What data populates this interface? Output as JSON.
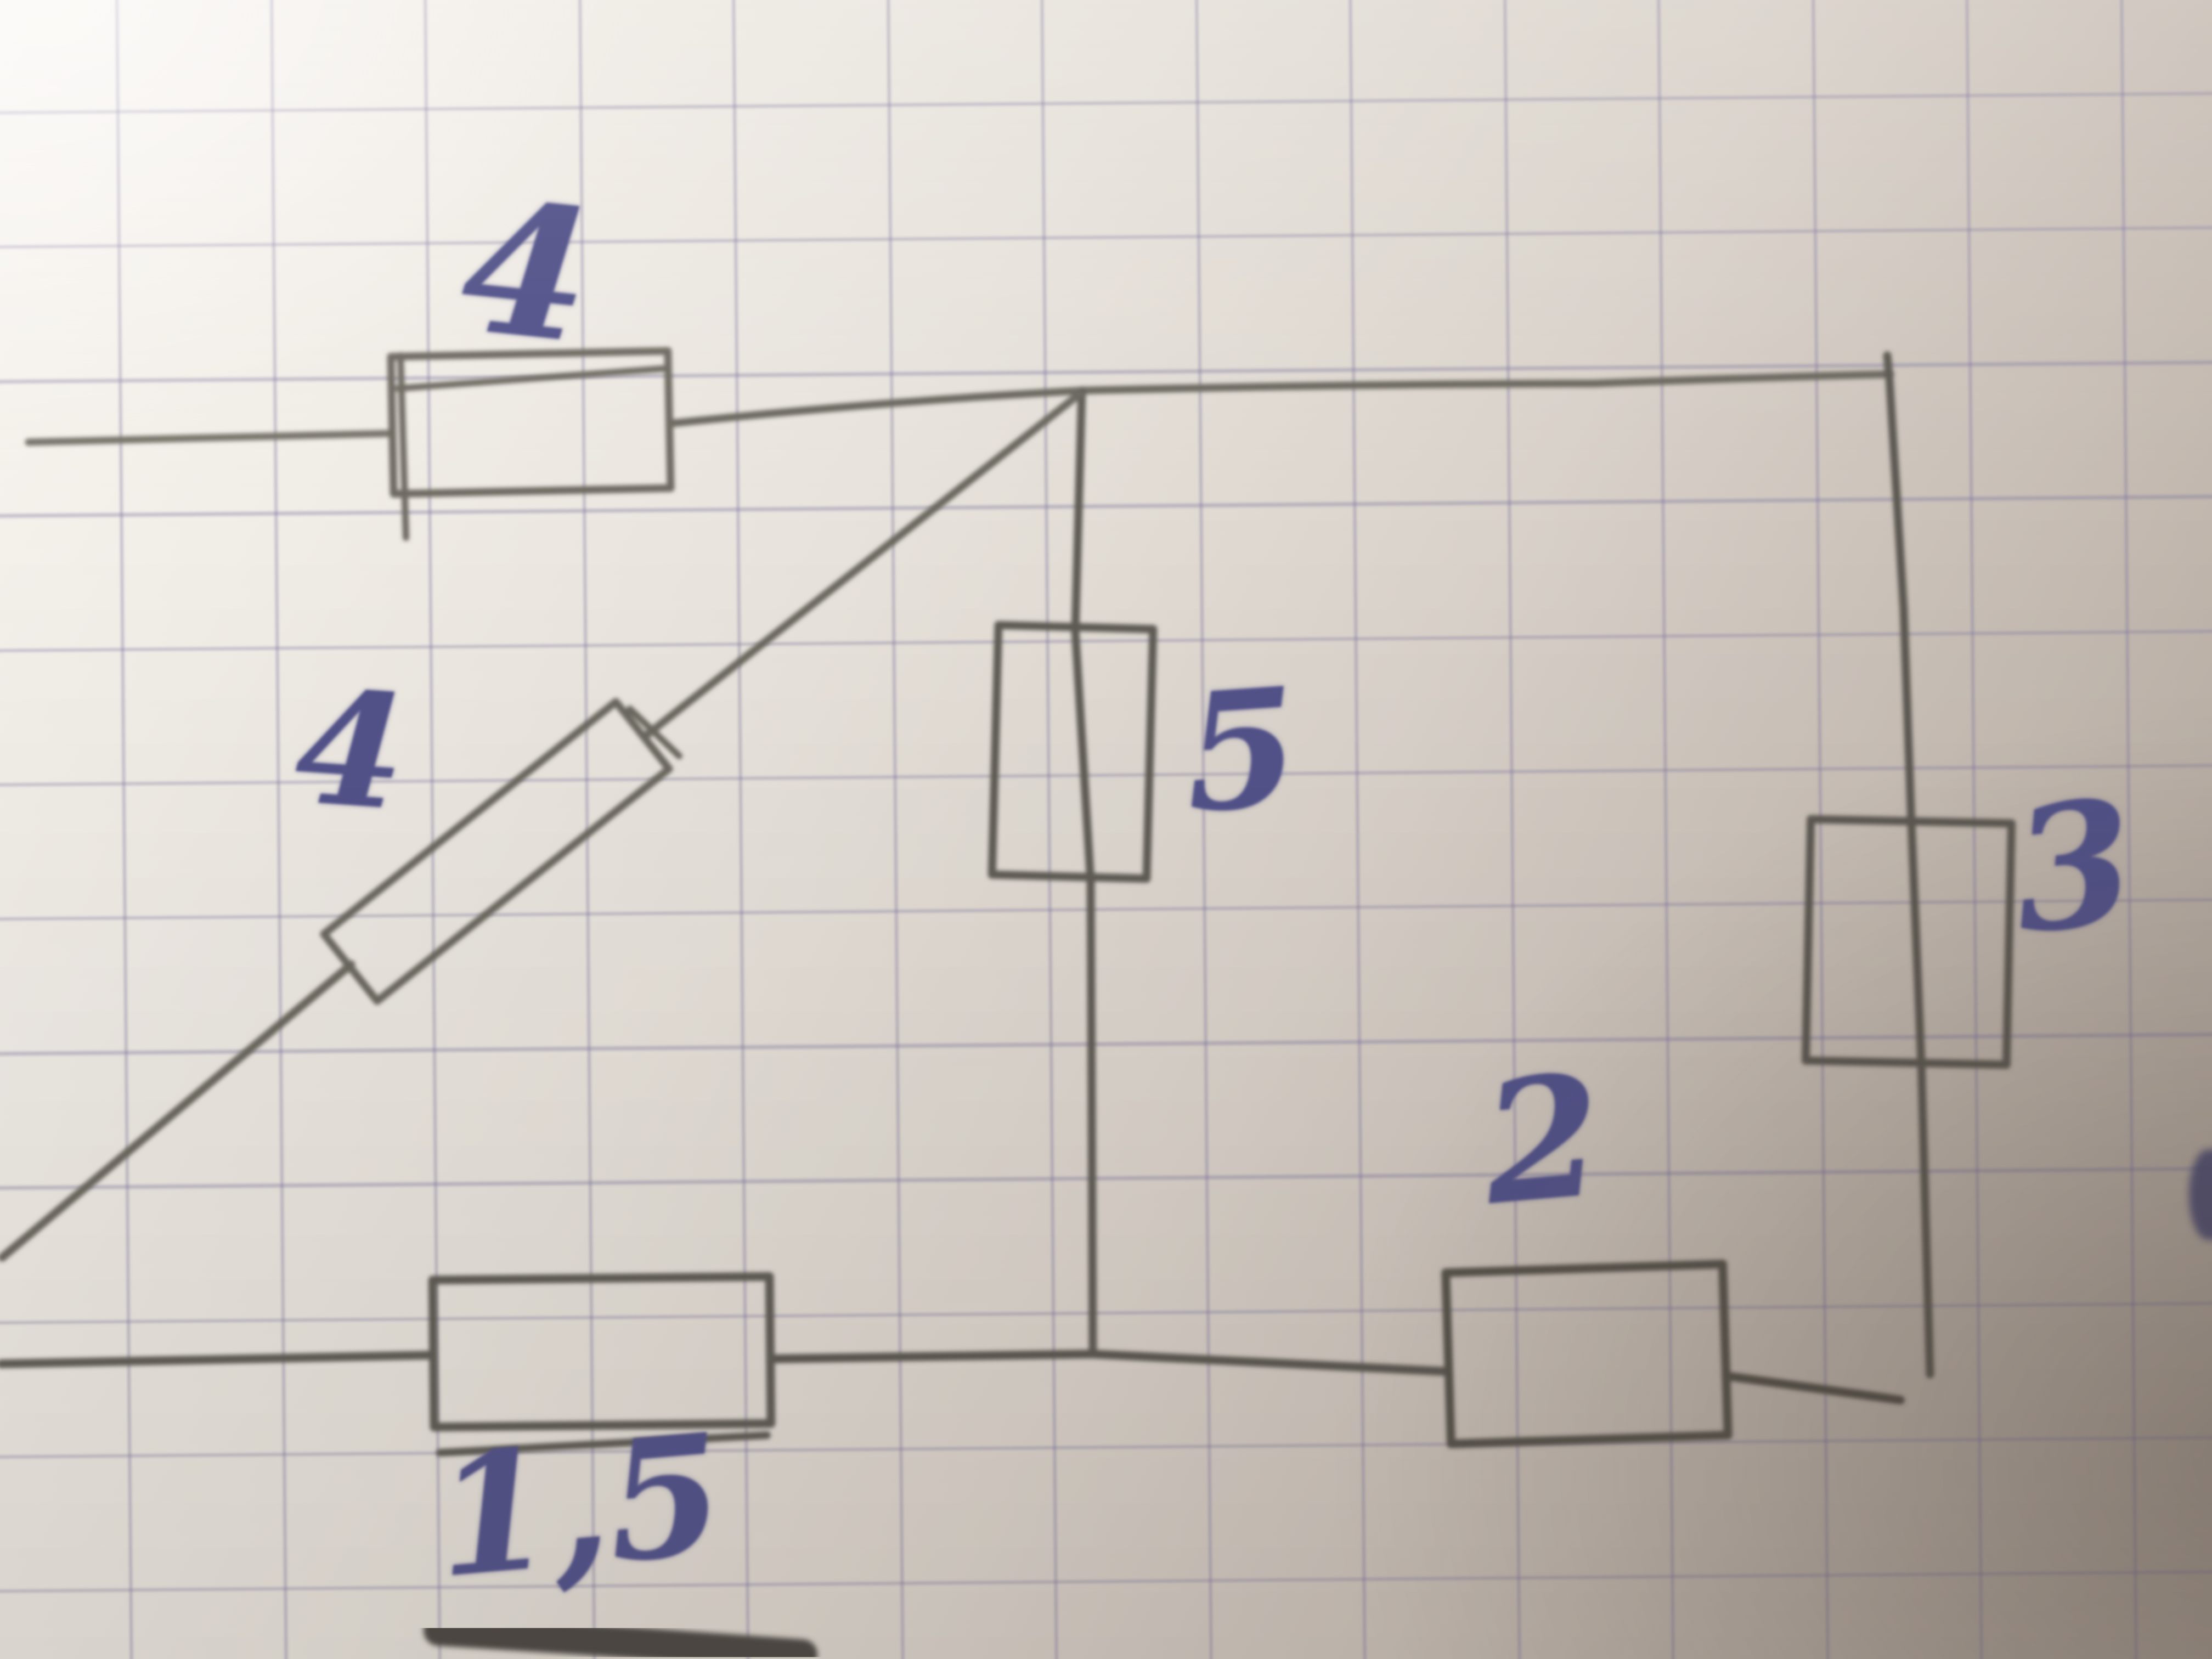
{
  "scene": {
    "description": "Hand-drawn electric circuit sketched in pencil on squared graph paper, photographed at an angle; resistor values written in blue ink",
    "paper_color": "#e7e2db",
    "grid_color": "#7a739c",
    "pencil_color": "#6b675f",
    "ink_color": "#52528a"
  },
  "circuit": {
    "labels": {
      "top": "4",
      "diagonal": "4",
      "middle": "5",
      "right": "3",
      "bottom_right": "2",
      "bottom_left": "1,5"
    },
    "components": [
      {
        "id": "resistor-top",
        "value": "4",
        "orientation": "horizontal",
        "position": "top wire, left section"
      },
      {
        "id": "resistor-diagonal",
        "value": "4",
        "orientation": "diagonal",
        "position": "diagonal branch from top node toward lower-left"
      },
      {
        "id": "resistor-middle",
        "value": "5",
        "orientation": "vertical",
        "position": "middle vertical branch between top node and bottom wire"
      },
      {
        "id": "resistor-right",
        "value": "3",
        "orientation": "vertical",
        "position": "right vertical branch"
      },
      {
        "id": "resistor-bottom-right",
        "value": "2",
        "orientation": "horizontal",
        "position": "bottom wire, right section"
      },
      {
        "id": "resistor-bottom-left",
        "value": "1,5",
        "orientation": "horizontal",
        "position": "bottom wire, left section"
      }
    ]
  }
}
